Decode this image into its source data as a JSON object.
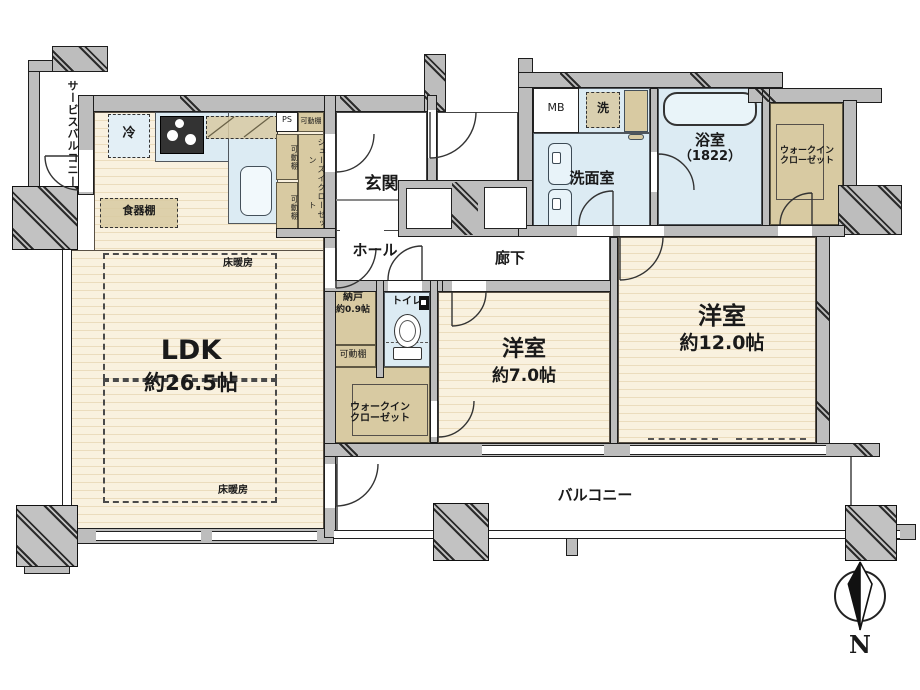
{
  "plan": {
    "service_balcony": {
      "line1": "サービス",
      "line2": "バルコニー"
    },
    "refrigerator": "冷",
    "cupboard": "食器棚",
    "ps": "PS",
    "shelf": "可動棚",
    "sic": {
      "line1": "シューズイン",
      "line2": "クローゼット"
    },
    "genkan": "玄関",
    "hall": "ホール",
    "ldk": {
      "name": "LDK",
      "size": "約26.5帖"
    },
    "floor_heating": "床暖房",
    "nando": {
      "name": "納戸",
      "size": "約0.9帖"
    },
    "toilet": "トイレ",
    "wic": {
      "line1": "ウォークイン",
      "line2": "クローゼット"
    },
    "room7": {
      "name": "洋室",
      "size": "約7.0帖"
    },
    "corridor": "廊下",
    "room12": {
      "name": "洋室",
      "size": "約12.0帖"
    },
    "mb": "MB",
    "laundry": "洗",
    "washroom": "洗面室",
    "bath": {
      "name": "浴室",
      "size": "（1822）"
    },
    "wic_ne": {
      "line1": "ウォークイン",
      "line2": "クローゼット"
    },
    "balcony": "バルコニー",
    "compass": "N"
  },
  "colors": {
    "wall": "#bdbdbd",
    "floor": "#f9f1df",
    "floor_stripe": "#ebdcbd",
    "water_blue": "#dcebf3",
    "closet_tan": "#d8caa2",
    "outline": "#1d1d1d"
  }
}
